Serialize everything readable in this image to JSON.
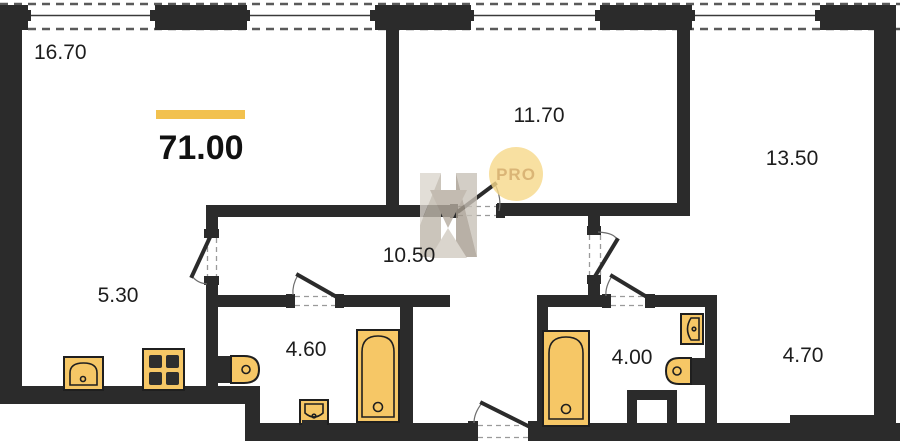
{
  "plan": {
    "total_area": "71.00",
    "badge_text": "PRO",
    "room_areas": [
      "16.70",
      "11.70",
      "13.50",
      "10.50",
      "5.30",
      "4.60",
      "4.00",
      "4.70"
    ],
    "colors": {
      "wall": "#2b2b2b",
      "fixture_fill": "#f6c766",
      "accent_bar": "#f2c14e",
      "badge_bg": "#f7d98a",
      "badge_text_color": "#d2a355"
    }
  }
}
